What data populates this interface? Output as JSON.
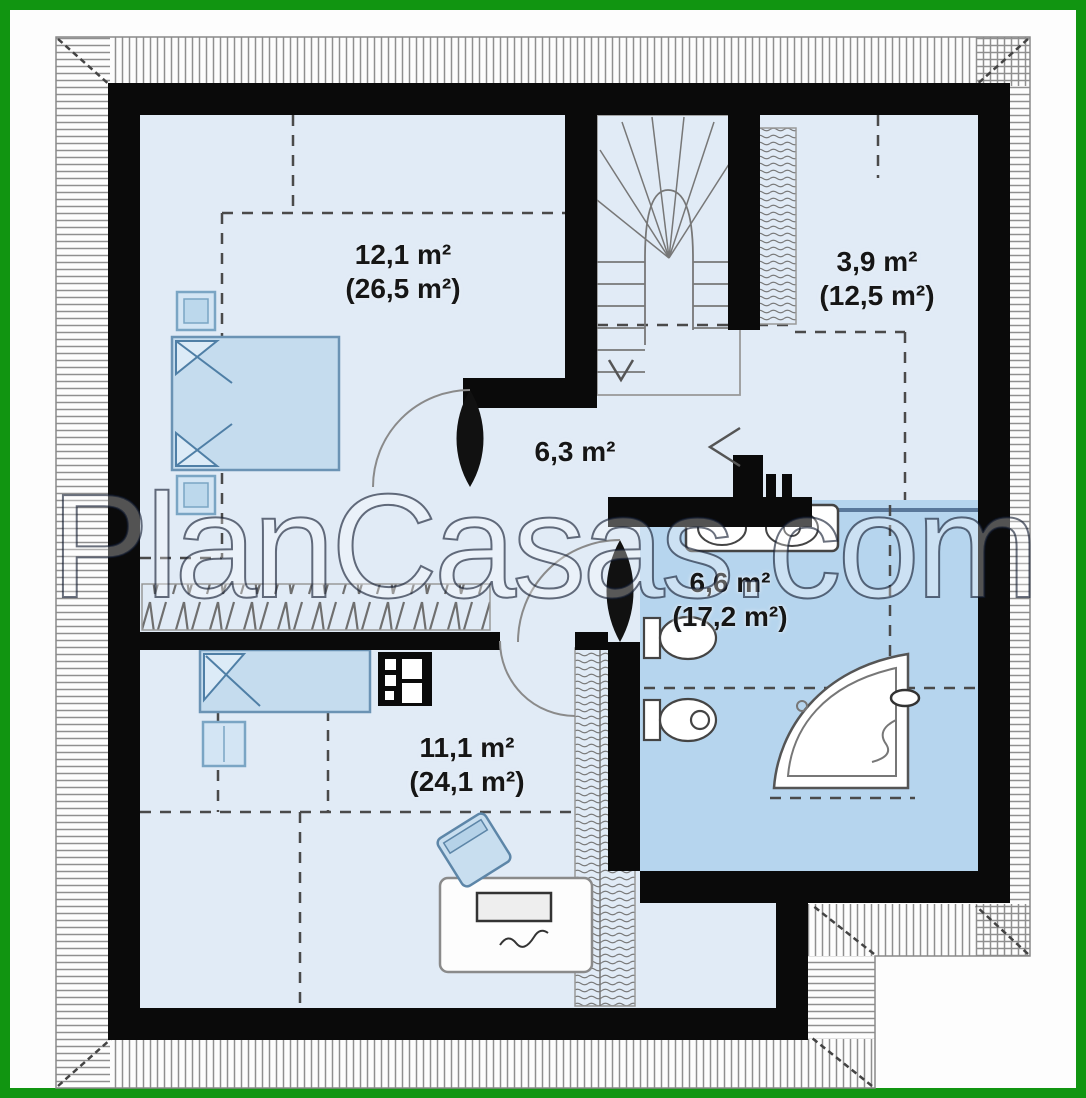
{
  "plan": {
    "title": "attic-floor-plan",
    "watermark": "PlanCasas.com",
    "rooms": [
      {
        "id": "bedroom-upper-left",
        "area": "12,1 m²",
        "gross_area": "(26,5 m²)"
      },
      {
        "id": "storage-upper-right",
        "area": "3,9 m²",
        "gross_area": "(12,5 m²)"
      },
      {
        "id": "hall-center",
        "area": "6,3 m²",
        "gross_area": ""
      },
      {
        "id": "bathroom",
        "area": "6,6 m²",
        "gross_area": "(17,2 m²)"
      },
      {
        "id": "room-lower",
        "area": "11,1 m²",
        "gross_area": "(24,1 m²)"
      }
    ],
    "colors": {
      "frame_green": "#119511",
      "wall_black": "#0a0a0a",
      "floor_light_blue": "#e1ebf6",
      "bathroom_blue": "#b6d5ee",
      "furniture_blue": "#c5dcee",
      "hatch_gray": "#8f8f8f"
    },
    "symbols": [
      "double-bed",
      "single-bed",
      "nightstand",
      "wardrobe",
      "chimney-flue",
      "u-shaped-staircase",
      "corner-bathtub",
      "toilet",
      "bidet",
      "double-washbasin",
      "radiator",
      "desk",
      "laptop",
      "chair"
    ]
  }
}
